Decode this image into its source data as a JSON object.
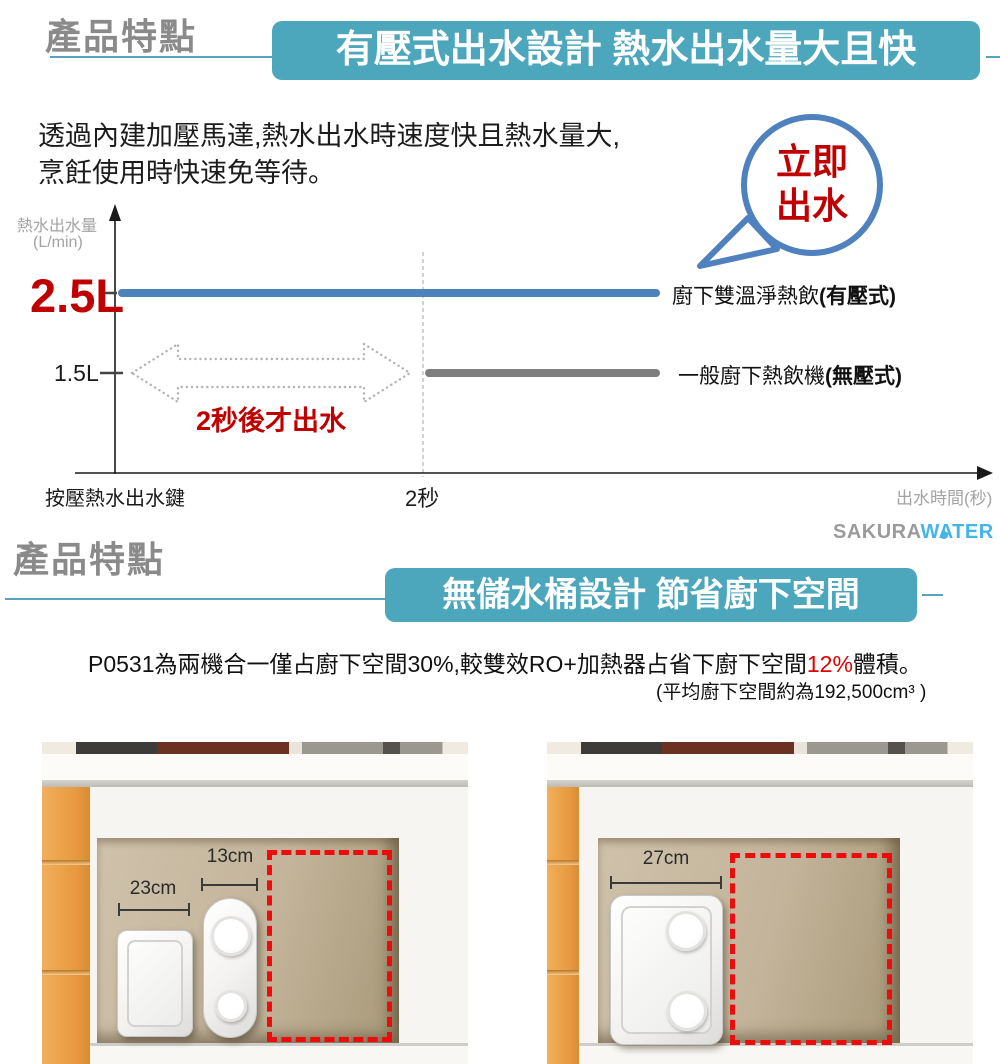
{
  "colors": {
    "banner_teal": "#4ca7bd",
    "title_gray": "#8a8a8a",
    "accent_red": "#c00000",
    "pressurized_line_blue": "#4f81bd",
    "regular_line_gray": "#7f7f7f",
    "axis_label_gray": "#a3a3a3",
    "bubble_stroke_blue": "#4e81bd",
    "logo_gray": "#9b9b9b",
    "logo_blue": "#45b5e8",
    "dashed_rect_red": "#ee0b0b",
    "cabinet_orange": "#e79a40"
  },
  "section1": {
    "title": "產品特點",
    "banner": "有壓式出水設計 熱水出水量大且快",
    "body_line1": "透過內建加壓馬達,熱水出水時速度快且熱水量大,",
    "body_line2": "烹飪使用時快速免等待。",
    "bubble_line1": "立即",
    "bubble_line2": "出水",
    "chart": {
      "y_axis_label_1": "熱水出水量",
      "y_axis_label_2": "(L/min)",
      "y_tick_major": "2.5L",
      "y_tick_minor": "1.5L",
      "series1_label": "廚下雙溫淨熱飲",
      "series1_label_bold": "(有壓式)",
      "series2_label": "一般廚下熱飲機",
      "series2_label_bold": "(無壓式)",
      "delay_label": "2秒後才出水",
      "x_origin_label": "按壓熱水出水鍵",
      "x_tick": "2秒",
      "x_axis_label": "出水時間(秒)"
    }
  },
  "logo": {
    "part1": "SAKURA",
    "part2": "WATER"
  },
  "section2": {
    "title": "產品特點",
    "banner": "無儲水桶設計 節省廚下空間",
    "para_p1": "P0531為兩機合一僅占廚下空間30%,較雙效RO+加熱器占省下廚下空間",
    "para_red": "12%",
    "para_p2": "體積。",
    "note": "(平均廚下空間約為192,500cm³ )",
    "left_image": {
      "dim_box": "23cm",
      "dim_pill": "13cm"
    },
    "right_image": {
      "dim_unit": "27cm"
    }
  },
  "chart_data": {
    "type": "line",
    "title": "有壓式出水設計 熱水出水量大且快",
    "xlabel": "出水時間(秒)",
    "ylabel": "熱水出水量 (L/min)",
    "x_origin_label": "按壓熱水出水鍵",
    "y_ticks": [
      1.5,
      2.5
    ],
    "y_tick_labels": [
      "1.5L",
      "2.5L"
    ],
    "x_ticks": [
      2
    ],
    "x_tick_labels": [
      "2秒"
    ],
    "grid": false,
    "series": [
      {
        "name": "廚下雙溫淨熱飲(有壓式)",
        "color": "#4f81bd",
        "points": [
          {
            "x": 0,
            "y": 2.5
          },
          {
            "x": 10,
            "y": 2.5
          }
        ],
        "annotation": "立即出水"
      },
      {
        "name": "一般廚下熱飲機(無壓式)",
        "color": "#7f7f7f",
        "points": [
          {
            "x": 2,
            "y": 1.5
          },
          {
            "x": 10,
            "y": 1.5
          }
        ],
        "annotation": "2秒後才出水"
      }
    ]
  }
}
